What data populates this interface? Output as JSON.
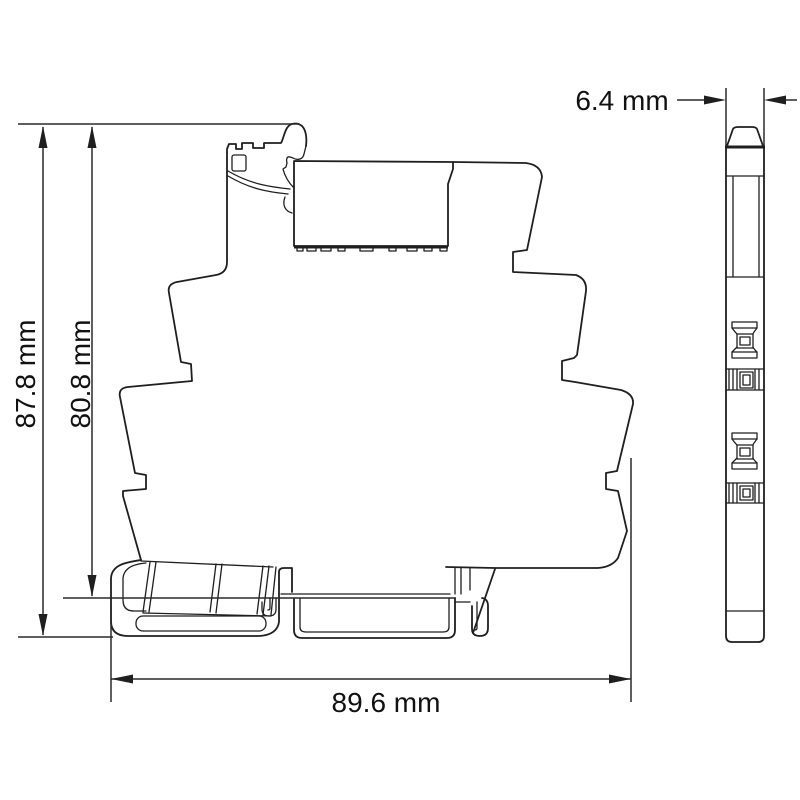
{
  "drawing": {
    "background": "#ffffff",
    "line_color": "#1f1f1f",
    "dimensions": {
      "total_height": "87.8 mm",
      "height_above_rail": "80.8 mm",
      "depth": "89.6 mm",
      "width": "6.4 mm"
    }
  }
}
